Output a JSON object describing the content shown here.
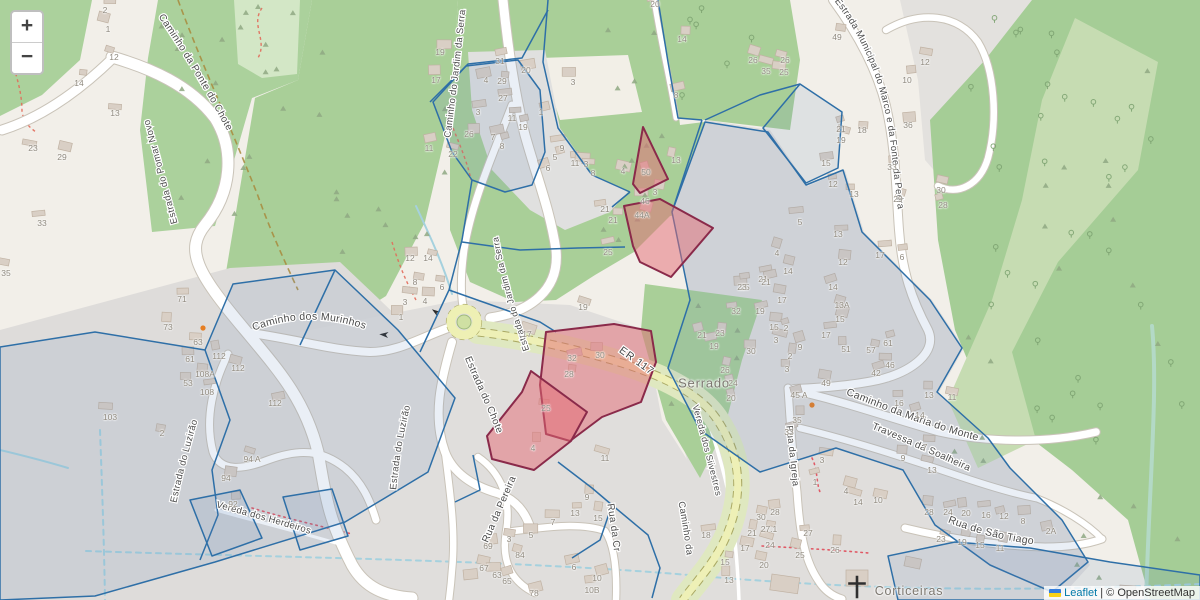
{
  "map": {
    "type": "leaflet-osm-map",
    "controls": {
      "zoom_in_label": "+",
      "zoom_out_label": "−"
    },
    "attribution": {
      "flag_icon": "ukraine-flag",
      "leaflet_link": "Leaflet",
      "separator": "|",
      "osm_text": "© OpenStreetMap"
    }
  },
  "place_labels": [
    {
      "text": "Serrado",
      "x": 704,
      "y": 383
    },
    {
      "text": "Corticeiras",
      "x": 909,
      "y": 591
    }
  ],
  "streets": [
    {
      "name": "Caminho da Ponte do Chote"
    },
    {
      "name": "Estrada do Pomar Novo"
    },
    {
      "name": "Caminho do Jardim da Serra"
    },
    {
      "name": "Estrada do Jardim da Serra"
    },
    {
      "name": "Estrada do Chote"
    },
    {
      "name": "Estrada do Luzirão"
    },
    {
      "name": "Estrada do Luzirão"
    },
    {
      "name": "Caminho dos Murinhos"
    },
    {
      "name": "Vereda dos Herdeiros"
    },
    {
      "name": "Rua da Pereira"
    },
    {
      "name": "ER 117"
    },
    {
      "name": "Vereda dos Silvestres"
    },
    {
      "name": "Caminho da Maria do Monte"
    },
    {
      "name": "Travessa da Soalheira"
    },
    {
      "name": "Rua da Igreja"
    },
    {
      "name": "Rua de São Tiago"
    },
    {
      "name": "Estrada Municipal do Marco e da Fonte da Pedra"
    },
    {
      "name": "Rua da Cr"
    },
    {
      "name": "Caminho da"
    }
  ],
  "highlighted_parcels": {
    "labels": [
      "50",
      "44A",
      "30",
      "25"
    ],
    "stroke": "#8a2a4a",
    "fill": "rgba(228,106,116,0.5)"
  },
  "overlay_layer": {
    "stroke": "#2e6fa7",
    "fill": "rgba(90,130,185,0.13)"
  },
  "icons": {
    "church_cross": "christian-cross",
    "one_way_arrow": "one-way-arrow",
    "turning_circle_color": "#e67e22"
  },
  "colors": {
    "base": "#f2efe9",
    "residential": "#dfdedc",
    "wood": "#a9cf98",
    "meadow": "#c6dcb2",
    "scrub": "#d3e7c6",
    "road": "#ffffff",
    "secondary_road": "#eef0b6",
    "stream": "#a5d1de",
    "link": "#0078A8"
  },
  "house_numbers": [
    [
      105,
      10,
      "2"
    ],
    [
      108,
      29,
      "1"
    ],
    [
      114,
      57,
      "12"
    ],
    [
      79,
      83,
      "14"
    ],
    [
      115,
      113,
      "13"
    ],
    [
      33,
      148,
      "23"
    ],
    [
      62,
      157,
      "29"
    ],
    [
      42,
      223,
      "33"
    ],
    [
      6,
      273,
      "35"
    ],
    [
      182,
      299,
      "71"
    ],
    [
      168,
      327,
      "73"
    ],
    [
      198,
      342,
      "63"
    ],
    [
      190,
      359,
      "61"
    ],
    [
      219,
      356,
      "112"
    ],
    [
      238,
      368,
      "112"
    ],
    [
      205,
      374,
      "108A"
    ],
    [
      207,
      392,
      "108"
    ],
    [
      188,
      383,
      "53"
    ],
    [
      110,
      417,
      "103"
    ],
    [
      275,
      403,
      "112"
    ],
    [
      162,
      433,
      "2"
    ],
    [
      252,
      459,
      "94 A"
    ],
    [
      226,
      478,
      "94"
    ],
    [
      233,
      504,
      "92"
    ],
    [
      440,
      52,
      "19"
    ],
    [
      436,
      80,
      "17"
    ],
    [
      486,
      80,
      "4"
    ],
    [
      502,
      81,
      "29"
    ],
    [
      500,
      61,
      "31"
    ],
    [
      526,
      70,
      "20"
    ],
    [
      503,
      98,
      "27"
    ],
    [
      478,
      112,
      "3"
    ],
    [
      469,
      134,
      "26"
    ],
    [
      429,
      148,
      "11"
    ],
    [
      453,
      154,
      "22"
    ],
    [
      493,
      137,
      "7"
    ],
    [
      502,
      146,
      "8"
    ],
    [
      512,
      118,
      "11"
    ],
    [
      523,
      127,
      "19"
    ],
    [
      541,
      112,
      "1"
    ],
    [
      562,
      148,
      "9"
    ],
    [
      548,
      168,
      "6"
    ],
    [
      555,
      157,
      "5"
    ],
    [
      575,
      163,
      "11"
    ],
    [
      586,
      164,
      "3"
    ],
    [
      573,
      82,
      "3"
    ],
    [
      655,
      4,
      "20"
    ],
    [
      682,
      39,
      "14"
    ],
    [
      676,
      95,
      "8"
    ],
    [
      753,
      60,
      "26"
    ],
    [
      766,
      71,
      "35"
    ],
    [
      623,
      171,
      "4"
    ],
    [
      593,
      173,
      "8"
    ],
    [
      676,
      160,
      "13"
    ],
    [
      646,
      172,
      "50"
    ],
    [
      655,
      192,
      "3"
    ],
    [
      645,
      201,
      "46"
    ],
    [
      605,
      209,
      "21"
    ],
    [
      613,
      220,
      "21"
    ],
    [
      642,
      215,
      "44A"
    ],
    [
      608,
      252,
      "25"
    ],
    [
      763,
      279,
      "21"
    ],
    [
      745,
      287,
      "25"
    ],
    [
      410,
      258,
      "12"
    ],
    [
      428,
      258,
      "14"
    ],
    [
      415,
      282,
      "8"
    ],
    [
      442,
      287,
      "6"
    ],
    [
      405,
      302,
      "3"
    ],
    [
      425,
      301,
      "4"
    ],
    [
      401,
      317,
      "1"
    ],
    [
      527,
      334,
      "17"
    ],
    [
      583,
      307,
      "19"
    ],
    [
      572,
      358,
      "32"
    ],
    [
      569,
      374,
      "28"
    ],
    [
      600,
      355,
      "30"
    ],
    [
      546,
      408,
      "25"
    ],
    [
      533,
      448,
      "4"
    ],
    [
      605,
      458,
      "11"
    ],
    [
      702,
      335,
      "21"
    ],
    [
      720,
      333,
      "23"
    ],
    [
      714,
      346,
      "19"
    ],
    [
      725,
      370,
      "26"
    ],
    [
      733,
      383,
      "24"
    ],
    [
      731,
      398,
      "20"
    ],
    [
      800,
      222,
      "5"
    ],
    [
      838,
      234,
      "13"
    ],
    [
      777,
      253,
      "4"
    ],
    [
      843,
      262,
      "12"
    ],
    [
      880,
      255,
      "17"
    ],
    [
      902,
      257,
      "6"
    ],
    [
      788,
      271,
      "14"
    ],
    [
      766,
      282,
      "21"
    ],
    [
      742,
      287,
      "23"
    ],
    [
      782,
      300,
      "17"
    ],
    [
      833,
      287,
      "14"
    ],
    [
      842,
      305,
      "13A"
    ],
    [
      736,
      311,
      "32"
    ],
    [
      760,
      311,
      "19"
    ],
    [
      840,
      319,
      "15"
    ],
    [
      774,
      327,
      "15"
    ],
    [
      786,
      328,
      "2"
    ],
    [
      776,
      340,
      "3"
    ],
    [
      826,
      335,
      "17"
    ],
    [
      751,
      351,
      "30"
    ],
    [
      800,
      347,
      "9"
    ],
    [
      790,
      356,
      "2"
    ],
    [
      846,
      349,
      "51"
    ],
    [
      871,
      350,
      "57"
    ],
    [
      888,
      343,
      "61"
    ],
    [
      890,
      365,
      "46"
    ],
    [
      876,
      373,
      "42"
    ],
    [
      787,
      369,
      "3"
    ],
    [
      837,
      37,
      "49"
    ],
    [
      785,
      60,
      "26"
    ],
    [
      784,
      72,
      "25"
    ],
    [
      925,
      62,
      "12"
    ],
    [
      907,
      80,
      "10"
    ],
    [
      908,
      125,
      "36"
    ],
    [
      841,
      129,
      "21"
    ],
    [
      841,
      140,
      "19"
    ],
    [
      862,
      130,
      "18"
    ],
    [
      826,
      163,
      "15"
    ],
    [
      833,
      184,
      "12"
    ],
    [
      854,
      194,
      "13"
    ],
    [
      892,
      167,
      "33"
    ],
    [
      898,
      199,
      "29"
    ],
    [
      941,
      190,
      "30"
    ],
    [
      943,
      205,
      "28"
    ],
    [
      826,
      383,
      "49"
    ],
    [
      799,
      395,
      "45 A"
    ],
    [
      797,
      420,
      "35"
    ],
    [
      789,
      432,
      "33"
    ],
    [
      899,
      403,
      "16"
    ],
    [
      920,
      415,
      "14"
    ],
    [
      929,
      395,
      "13"
    ],
    [
      952,
      397,
      "11"
    ],
    [
      925,
      447,
      "7"
    ],
    [
      903,
      458,
      "9"
    ],
    [
      932,
      470,
      "13"
    ],
    [
      822,
      460,
      "3"
    ],
    [
      815,
      482,
      "1"
    ],
    [
      846,
      491,
      "4"
    ],
    [
      858,
      502,
      "14"
    ],
    [
      878,
      500,
      "10"
    ],
    [
      929,
      512,
      "28"
    ],
    [
      948,
      512,
      "24"
    ],
    [
      966,
      513,
      "20"
    ],
    [
      986,
      515,
      "16"
    ],
    [
      1004,
      516,
      "12"
    ],
    [
      1023,
      521,
      "8"
    ],
    [
      1051,
      531,
      "2A"
    ],
    [
      941,
      539,
      "23"
    ],
    [
      962,
      542,
      "19"
    ],
    [
      980,
      545,
      "15"
    ],
    [
      1000,
      548,
      "11"
    ],
    [
      706,
      535,
      "18"
    ],
    [
      752,
      533,
      "21"
    ],
    [
      745,
      548,
      "17"
    ],
    [
      725,
      562,
      "15"
    ],
    [
      729,
      580,
      "13"
    ],
    [
      775,
      512,
      "28"
    ],
    [
      769,
      529,
      "27.1"
    ],
    [
      808,
      533,
      "27"
    ],
    [
      770,
      545,
      "24"
    ],
    [
      761,
      517,
      "30"
    ],
    [
      800,
      555,
      "25"
    ],
    [
      835,
      550,
      "26"
    ],
    [
      764,
      565,
      "20"
    ],
    [
      587,
      497,
      "9"
    ],
    [
      575,
      513,
      "13"
    ],
    [
      598,
      518,
      "15"
    ],
    [
      531,
      535,
      "5"
    ],
    [
      509,
      539,
      "3"
    ],
    [
      553,
      522,
      "7"
    ],
    [
      488,
      546,
      "69"
    ],
    [
      484,
      568,
      "67"
    ],
    [
      520,
      555,
      "84"
    ],
    [
      574,
      567,
      "6"
    ],
    [
      597,
      578,
      "10"
    ],
    [
      592,
      590,
      "10B"
    ],
    [
      507,
      581,
      "65"
    ],
    [
      497,
      575,
      "63"
    ],
    [
      534,
      593,
      "78"
    ]
  ]
}
